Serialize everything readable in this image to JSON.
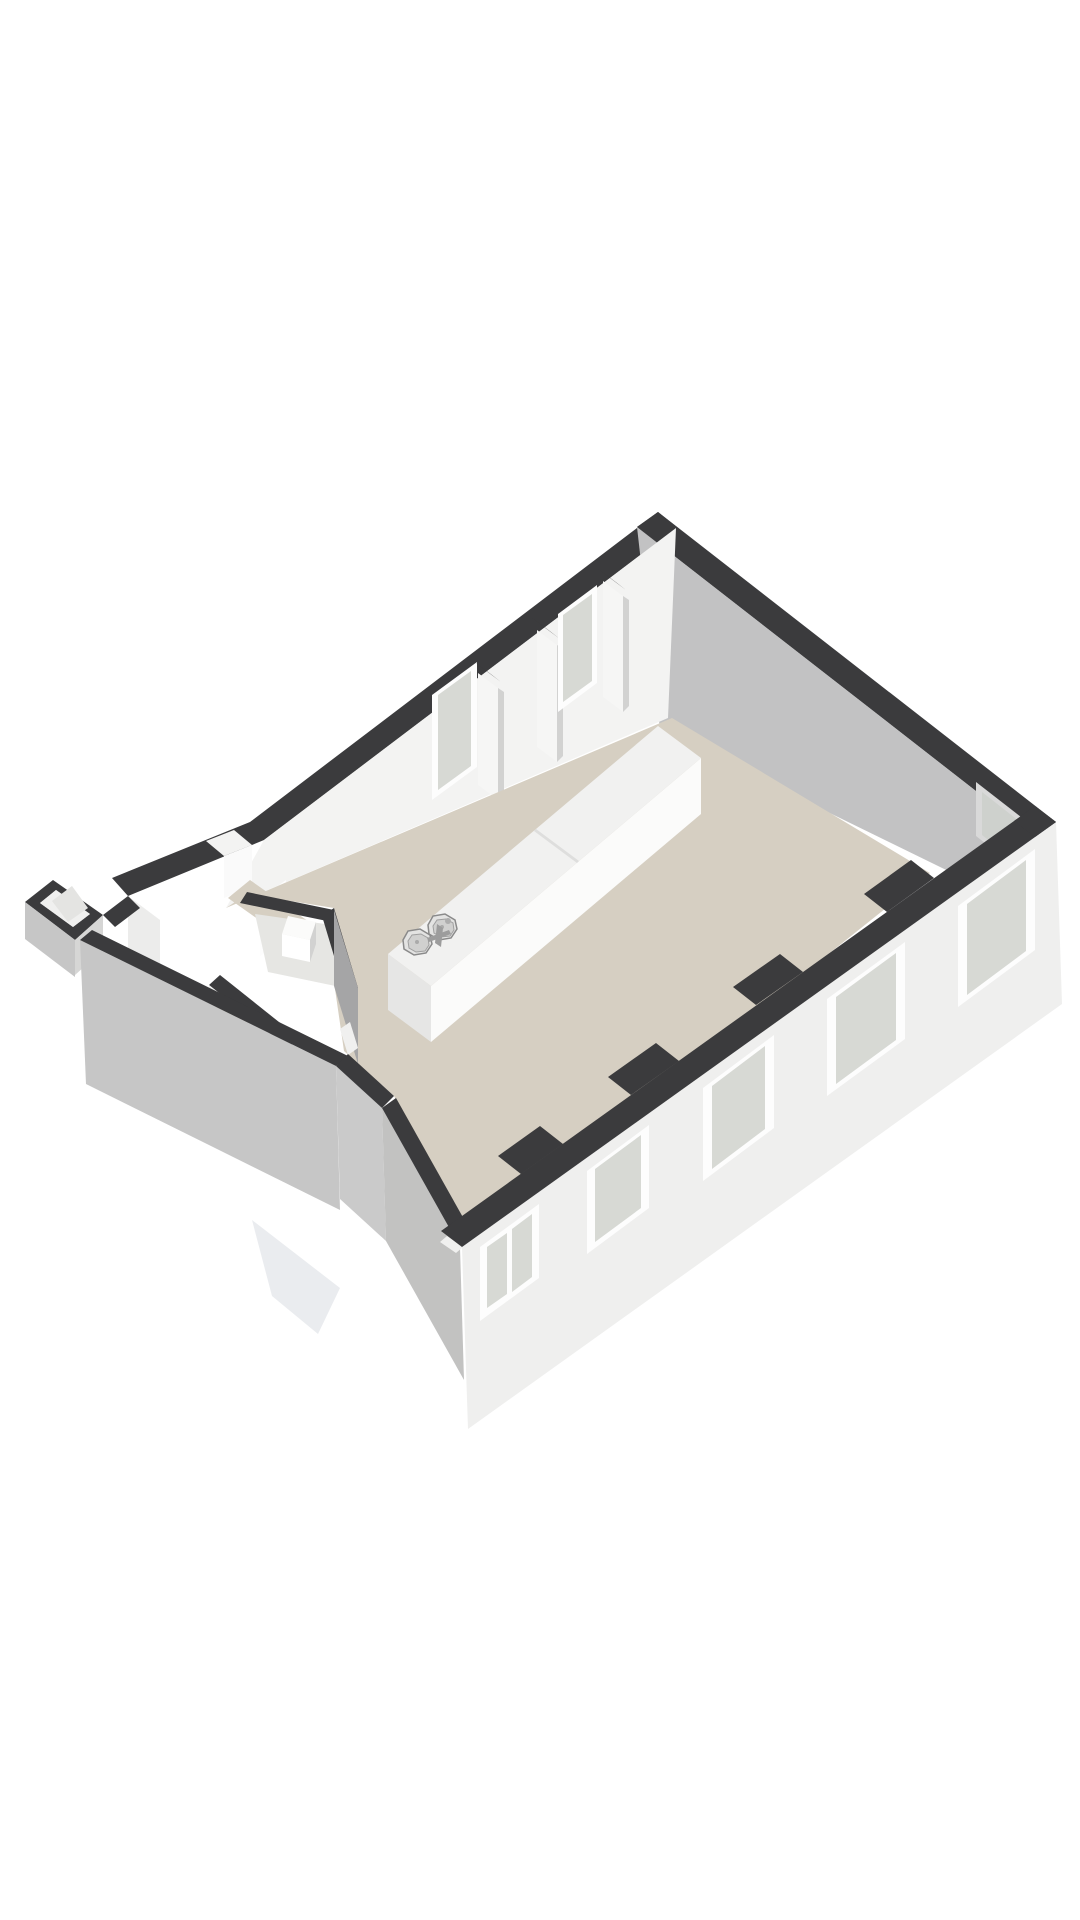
{
  "meta": {
    "scene": "3d-floorplan-render",
    "description": "Isometric 3D floor plan of an open-plan space with kitchen island, entrance hallway with small rooms, windowed facade walls and a chamfered corner wall",
    "background": "#ffffff"
  },
  "canvas": {
    "width": 1080,
    "height": 1920,
    "viewBox": "0 0 1080 1920"
  },
  "palette": {
    "dark": "#3b3b3d",
    "floor": "#d6cfc2",
    "floorShade": "#ccc5b7",
    "roomPale": "#e6e6e3",
    "intFaceNW": "#f3f3f2",
    "neFace": "#c2c2c3",
    "extSE": "#efefee",
    "extSW": "#c6c6c6",
    "extSE2": "#d6d6d5",
    "diagGray": "#c2c2c1",
    "shallowGray": "#cacaca",
    "glass": "#d7d9d4",
    "glassCool": "#ced1cd",
    "frame": "#fdfdfd",
    "white": "#ffffff",
    "pierFace": "#f6f6f5",
    "pierShade": "#d2d2d1",
    "grayFace": "#a5a5a6",
    "lightFace": "#ececeb",
    "overlayLight": "#f3f3f2",
    "threshold": "#fafafa",
    "boxIn": "#f0f0ef",
    "boxFloor": "#e4e4e2",
    "wedge": "#eaecef",
    "counterTop": "#f1f1f0",
    "counterFront": "#fbfbfa",
    "counterEnd": "#e6e6e5",
    "seam": "#dededd",
    "steel": "#e3e3e2",
    "steelInner": "#d0d0cf",
    "steelStroke": "#8a8a8a",
    "steelStroke2": "#a0a0a0",
    "metal": "#9c9c9c",
    "metalLight": "#adadad",
    "drain": "#aaaaaa",
    "wallFaceWhite": "#f2f2f1",
    "grayNotch": "#d9d9d9"
  },
  "floorplan": {
    "elements": [
      {
        "n": "ne-exterior-wall-top",
        "t": "polygon",
        "p": "658,512 1056,822 1035,837 637,527",
        "f": "dark"
      },
      {
        "n": "nw-exterior-wall-top",
        "t": "path",
        "p": "M658,512 L250,822 L112,878 L128,896 L264,840 L676,528 Z",
        "f": "dark"
      },
      {
        "n": "north-corner-wall-top",
        "t": "polygon",
        "p": "658,512 637,527 658,543 678,528",
        "f": "dark"
      },
      {
        "n": "ne-wall-interior-face",
        "t": "polygon",
        "p": "637,527 1035,837 1028,910 660,730",
        "f": "neFace"
      },
      {
        "n": "ne-window-frame",
        "t": "polygon",
        "p": "976,782 1030,824 1030,878 976,836",
        "f": "grayNotch"
      },
      {
        "n": "ne-window-glass",
        "t": "polygon",
        "p": "982,792 1024,825 1024,868 982,835",
        "f": "glassCool"
      },
      {
        "n": "nw-wall-interior-face",
        "t": "polygon",
        "p": "676,528 264,840 226,908 668,718",
        "f": "intFaceNW"
      },
      {
        "n": "entry-door-gap",
        "t": "polygon",
        "p": "234,830 206,841 224,856 252,845",
        "f": "overlayLight"
      },
      {
        "n": "entry-door-threshold",
        "t": "polygon",
        "p": "252,845 224,856 224,898 252,887",
        "f": "threshold"
      },
      {
        "n": "entry-glazed-panel-frame",
        "t": "polygon",
        "p": "286,880 260,899 260,956 286,937",
        "f": "frame"
      },
      {
        "n": "entry-glazed-panel-glass",
        "t": "polygon",
        "p": "281,887 265,899 265,948 281,936",
        "f": "glass"
      },
      {
        "n": "nw-window-1-frame",
        "t": "polygon",
        "p": "477,662 432,695 432,800 477,767",
        "f": "frame"
      },
      {
        "n": "nw-window-1-glass",
        "t": "polygon",
        "p": "471,671 438,695 438,790 471,766",
        "f": "glass"
      },
      {
        "n": "pier-a-top",
        "t": "polygon",
        "p": "472,660 492,675 501,682 481,667",
        "f": "dark"
      },
      {
        "n": "pier-a-face",
        "t": "polygon",
        "p": "478,673 498,688 498,800 478,785",
        "f": "pierFace"
      },
      {
        "n": "pier-a-shade",
        "t": "polygon",
        "p": "498,688 504,692 504,794 498,800",
        "f": "pierShade"
      },
      {
        "n": "pier-b-top",
        "t": "polygon",
        "p": "531,617 551,632 560,639 540,624",
        "f": "dark"
      },
      {
        "n": "pier-b-face",
        "t": "polygon",
        "p": "537,630 557,645 557,762 537,747",
        "f": "pierFace"
      },
      {
        "n": "pier-b-shade",
        "t": "polygon",
        "p": "557,645 563,649 563,756 557,762",
        "f": "pierShade"
      },
      {
        "n": "nw-window-2-frame",
        "t": "polygon",
        "p": "597,585 558,614 558,712 597,683",
        "f": "frame"
      },
      {
        "n": "nw-window-2-glass",
        "t": "polygon",
        "p": "592,594 563,615 563,702 592,681",
        "f": "glass"
      },
      {
        "n": "pier-c-top",
        "t": "polygon",
        "p": "597,568 617,583 626,590 606,575",
        "f": "dark"
      },
      {
        "n": "pier-c-face",
        "t": "polygon",
        "p": "603,581 623,596 623,712 603,697",
        "f": "pierFace"
      },
      {
        "n": "pier-c-shade",
        "t": "polygon",
        "p": "623,596 629,600 629,706 623,712",
        "f": "pierShade"
      },
      {
        "n": "main-floor",
        "t": "path",
        "p": "M672,718 L930,873 L474,1237 L394,1096 L344,1051 L334,982 L334,908 L247,894 L226,908 Z",
        "f": "floor"
      },
      {
        "n": "hallway-floor",
        "t": "polygon",
        "p": "250,880 384,975 362,993 228,898",
        "f": "floor"
      },
      {
        "n": "hall-wall-top",
        "t": "polygon",
        "p": "247,892 334,910 327,921 240,903",
        "f": "dark"
      },
      {
        "n": "small-room-1-floor",
        "t": "polygon",
        "p": "255,914 325,924 345,988 268,972",
        "f": "roomPale"
      },
      {
        "n": "fixture-top",
        "t": "polygon",
        "p": "288,916 316,922 310,940 282,934",
        "f": "counterFront"
      },
      {
        "n": "fixture-front",
        "t": "polygon",
        "p": "282,934 310,940 310,962 282,956",
        "f": "white"
      },
      {
        "n": "fixture-side",
        "t": "polygon",
        "p": "310,940 316,922 316,944 310,962",
        "f": "pierShade"
      },
      {
        "n": "room-divider-wall-top",
        "t": "polygon",
        "p": "334,908 358,988 346,996 322,916",
        "f": "dark"
      },
      {
        "n": "room-divider-wall-face",
        "t": "polygon",
        "p": "334,910 358,988 358,1064 334,986",
        "f": "grayFace"
      },
      {
        "n": "room-divider-door-gap",
        "t": "polygon",
        "p": "350,1022 358,1048 348,1055 340,1029",
        "f": "boxIn"
      },
      {
        "n": "lower-room-wall-top",
        "t": "polygon",
        "p": "220,975 299,1038 288,1048 209,985",
        "f": "dark"
      },
      {
        "n": "lower-room-wall-face",
        "t": "polygon",
        "p": "209,985 288,1048 288,1102 209,1039",
        "f": "wallFaceWhite"
      },
      {
        "n": "small-room-2-floor",
        "t": "polygon",
        "p": "222,1002 290,1056 268,1077 200,1023",
        "f": "floorShade"
      },
      {
        "n": "west-corner-interior-face",
        "t": "polygon",
        "p": "128,896 160,920 160,985 128,961",
        "f": "lightFace"
      },
      {
        "n": "bay-neck-top",
        "t": "polygon",
        "p": "103,915 128,896 140,908 115,927",
        "f": "dark"
      },
      {
        "n": "bay-rim-top",
        "t": "path",
        "p": "M25,902 L53,880 L103,915 L75,940 Z M40,903 L56,890 L90,914 L73,927 Z",
        "f": "dark"
      },
      {
        "n": "bay-interior",
        "t": "polygon",
        "p": "40,903 56,890 90,914 73,927",
        "f": "boxIn"
      },
      {
        "n": "bay-interior-floor",
        "t": "polygon",
        "p": "52,901 72,886 88,908 68,922",
        "f": "boxFloor"
      },
      {
        "n": "bay-exterior-sw",
        "t": "polygon",
        "p": "25,902 75,940 75,977 25,939",
        "f": "extSW"
      },
      {
        "n": "bay-exterior-se",
        "t": "polygon",
        "p": "75,940 103,915 103,950 75,975",
        "f": "extSE2"
      },
      {
        "n": "sw-wall-exterior-face",
        "t": "polygon",
        "p": "80,940 336,1066 340,1210 86,1084",
        "f": "extSW"
      },
      {
        "n": "sw-wall-top",
        "t": "polygon",
        "p": "80,940 336,1066 348,1056 92,930",
        "f": "dark"
      },
      {
        "n": "chamfer-low-face",
        "t": "polygon",
        "p": "336,1066 382,1108 386,1241 340,1199",
        "f": "shallowGray"
      },
      {
        "n": "chamfer-low-top",
        "t": "polygon",
        "p": "336,1066 382,1108 394,1096 348,1054",
        "f": "dark"
      },
      {
        "n": "chamfer-wall-face",
        "t": "polygon",
        "p": "382,1108 460,1247 464,1380 386,1241",
        "f": "diagGray"
      },
      {
        "n": "chamfer-wall-top",
        "t": "polygon",
        "p": "382,1108 460,1247 474,1237 396,1098",
        "f": "dark"
      },
      {
        "n": "chamfer-door-sliver",
        "t": "polygon",
        "p": "447,1236 463,1247 456,1253 440,1242",
        "f": "boxIn"
      },
      {
        "n": "lower-exterior-wedge",
        "t": "polygon",
        "p": "252,1220 340,1288 318,1334 272,1296",
        "f": "wedge"
      },
      {
        "n": "se-wall-exterior-face",
        "t": "polygon",
        "p": "462,1247 1056,822 1062,1004 468,1429",
        "f": "extSE"
      },
      {
        "n": "se-wall-top",
        "t": "polygon",
        "p": "462,1247 1056,822 1035,806 441,1231",
        "f": "dark"
      },
      {
        "n": "east-corner-wall-top",
        "t": "polygon",
        "p": "1056,822 1035,837 1014,821 1035,806",
        "f": "dark"
      },
      {
        "n": "se-wall-pier-top-1",
        "t": "polygon",
        "p": "934,878 887,912 864,894 911,860",
        "f": "dark"
      },
      {
        "n": "se-wall-pier-top-2",
        "t": "polygon",
        "p": "803,972 756,1005 733,987 780,954",
        "f": "dark"
      },
      {
        "n": "se-wall-pier-top-3",
        "t": "polygon",
        "p": "679,1061 631,1095 608,1077 656,1043",
        "f": "dark"
      },
      {
        "n": "se-wall-pier-top-4",
        "t": "polygon",
        "p": "563,1144 521,1174 498,1156 540,1126",
        "f": "dark"
      },
      {
        "n": "se-window-1-frame",
        "t": "polygon",
        "p": "1035,849 958,906 958,1007 1035,950",
        "f": "frame"
      },
      {
        "n": "se-window-1-glass",
        "t": "polygon",
        "p": "1026,860 967,904 967,995 1026,951",
        "f": "glass"
      },
      {
        "n": "se-window-2-frame",
        "t": "polygon",
        "p": "905,942 827,999 827,1096 905,1039",
        "f": "frame"
      },
      {
        "n": "se-window-2-glass",
        "t": "polygon",
        "p": "896,953 836,997 836,1084 896,1040",
        "f": "glass"
      },
      {
        "n": "se-window-3-frame",
        "t": "polygon",
        "p": "774,1035 703,1088 703,1181 774,1128",
        "f": "frame"
      },
      {
        "n": "se-window-3-glass",
        "t": "polygon",
        "p": "765,1046 712,1086 712,1169 765,1129",
        "f": "glass"
      },
      {
        "n": "se-window-4-frame",
        "t": "polygon",
        "p": "649,1125 587,1171 587,1254 649,1208",
        "f": "frame"
      },
      {
        "n": "se-window-4-glass",
        "t": "polygon",
        "p": "641,1135 595,1169 595,1242 641,1208",
        "f": "glass"
      },
      {
        "n": "se-window-5-frame",
        "t": "polygon",
        "p": "539,1204 480,1247 480,1321 539,1278",
        "f": "frame"
      },
      {
        "n": "se-window-5-glass-left",
        "t": "polygon",
        "p": "532,1214 512,1229 512,1292 532,1277",
        "f": "glass"
      },
      {
        "n": "se-window-5-glass-right",
        "t": "polygon",
        "p": "507,1233 487,1247 487,1308 507,1294",
        "f": "glass"
      },
      {
        "n": "kitchen-island-front-face",
        "t": "polygon",
        "p": "701,758 431,986 431,1042 701,814",
        "f": "counterFront"
      },
      {
        "n": "kitchen-island-end-face",
        "t": "polygon",
        "p": "388,954 431,986 431,1042 388,1010",
        "f": "counterEnd"
      },
      {
        "n": "kitchen-island-top",
        "t": "polygon",
        "p": "658,726 701,758 431,986 388,954",
        "f": "counterTop"
      },
      {
        "n": "kitchen-island-seam",
        "t": "polygon",
        "p": "536,829 579,861 577,863 534,831",
        "f": "seam"
      },
      {
        "n": "sink-basin-2-rim",
        "t": "polygon",
        "p": "428,925 433,916 445,914 455,920 457,929 451,938 439,940 429,934",
        "f": "steel",
        "s": "steelStroke",
        "w": 1.5
      },
      {
        "n": "sink-basin-2-inner",
        "t": "polygon",
        "p": "433,926 437,920 446,919 453,923 454,930 450,936 441,937 434,933",
        "f": "steelInner",
        "s": "steelStroke2",
        "w": 1
      },
      {
        "n": "sink-basin-1-rim",
        "t": "polygon",
        "p": "403,940 408,931 420,929 430,935 432,944 426,953 414,955 404,949",
        "f": "steel",
        "s": "steelStroke",
        "w": 1.5
      },
      {
        "n": "sink-basin-1-inner",
        "t": "polygon",
        "p": "408,941 412,935 421,934 428,938 429,945 425,951 416,952 409,948",
        "f": "steelInner",
        "s": "steelStroke2",
        "w": 1
      },
      {
        "n": "sink-drain-1",
        "t": "circle",
        "cx": 417,
        "cy": 942,
        "r": 2,
        "f": "drain"
      },
      {
        "n": "sink-drain-2",
        "t": "circle",
        "cx": 442,
        "cy": 927,
        "r": 2,
        "f": "drain"
      },
      {
        "n": "faucet-stem",
        "t": "polygon",
        "p": "437,924 443,928 441,947 435,943",
        "f": "metal"
      },
      {
        "n": "faucet-bar",
        "t": "polygon",
        "p": "427,938 449,930 451,934 429,942",
        "f": "metal"
      },
      {
        "n": "faucet-handle",
        "t": "circle",
        "cx": 448,
        "cy": 921,
        "r": 3,
        "f": "metalLight"
      }
    ]
  }
}
